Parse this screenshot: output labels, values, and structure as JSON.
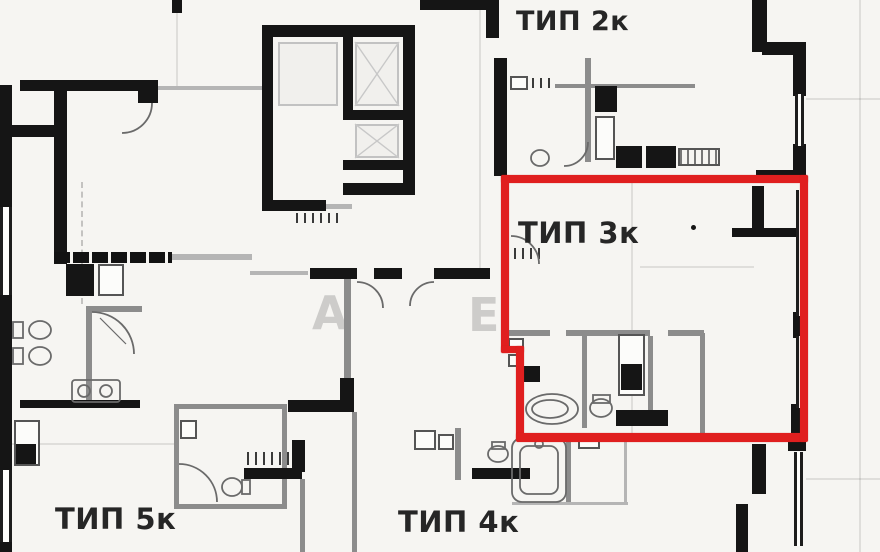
{
  "page": {
    "type": "apartment-floor-plan"
  },
  "units": {
    "unit_2k": {
      "label": "ТИП 2к"
    },
    "unit_3k": {
      "label": "ТИП 3к",
      "highlighted": true
    },
    "unit_4k": {
      "label": "ТИП 4к"
    },
    "unit_5k": {
      "label": "ТИП 5к"
    }
  },
  "highlight": {
    "unit": "ТИП 3к",
    "color": "#e01f1f"
  },
  "watermark": {
    "letter_1": "А",
    "letter_2": "Е"
  },
  "colors": {
    "background": "#f6f5f2",
    "wall": "#151515",
    "partition": "#8c8c8c"
  }
}
